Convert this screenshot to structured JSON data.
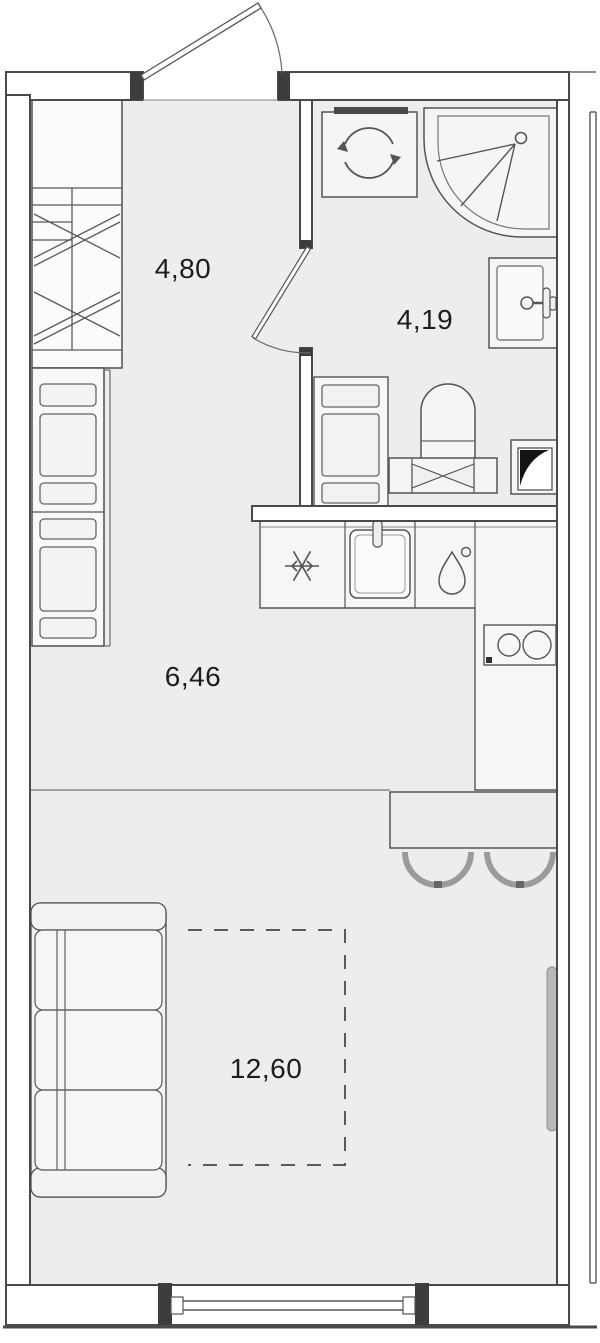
{
  "plan": {
    "kind": "studio-apartment-floor-plan",
    "rooms": {
      "hallway": {
        "area_label": "4,80"
      },
      "bathroom": {
        "area_label": "4,19"
      },
      "kitchen": {
        "area_label": "6,46"
      },
      "living_room": {
        "area_label": "12,60"
      }
    },
    "fixtures": [
      "entry-door",
      "bathroom-door",
      "wardrobe",
      "hallway-cabinets",
      "washing-machine",
      "shower-cabin",
      "bathroom-sink",
      "bathroom-cabinet",
      "toilet",
      "vent-shaft",
      "kitchen-counter",
      "fridge",
      "kitchen-sink",
      "water-heater-drop",
      "stove-two-burners",
      "bar-counter",
      "bar-stools",
      "sofa",
      "bed-dashed-outline",
      "radiator",
      "window"
    ],
    "colors": {
      "floor": "#ededed",
      "wall_fill": "#ffffff",
      "outline": "#4a4a4a",
      "furniture_fill": "#f6f6f6",
      "jamb_dark": "#3d3d3d",
      "text": "#1d1d1d",
      "radiator": "#b8b8b8",
      "stool": "#9b9b9b"
    }
  }
}
